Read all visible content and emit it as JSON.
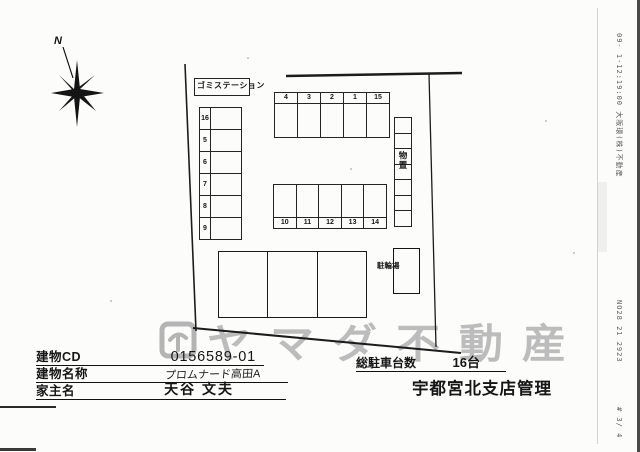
{
  "document": {
    "compass_label": "N",
    "watermark": {
      "text": "ヤマダ不動産",
      "color": "#bcbcbc"
    },
    "plan": {
      "trash_station": "ゴミステーション",
      "storage": "物置",
      "bicycle_parking": "駐輪場",
      "left_stalls": [
        "16",
        "5",
        "6",
        "7",
        "8",
        "9"
      ],
      "top_stalls": [
        "4",
        "3",
        "2",
        "1",
        "15"
      ],
      "middle_stalls": [
        "10",
        "11",
        "12",
        "13",
        "14"
      ]
    },
    "fields": {
      "building_cd_label": "建物CD",
      "building_cd_value": "0156589-01",
      "building_name_label": "建物名称",
      "building_name_value": "プロムナード高田A",
      "owner_label": "家主名",
      "owner_value": "天谷 文夫"
    },
    "summary": {
      "total_label": "総駐車台数",
      "total_value": "16台",
      "branch": "宇都宮北支店管理"
    },
    "fax": {
      "header": "09- 1-12:19:00  大阪環(株)不動産",
      "code": "NO28 21 2923",
      "page": "# 3/ 4"
    }
  }
}
